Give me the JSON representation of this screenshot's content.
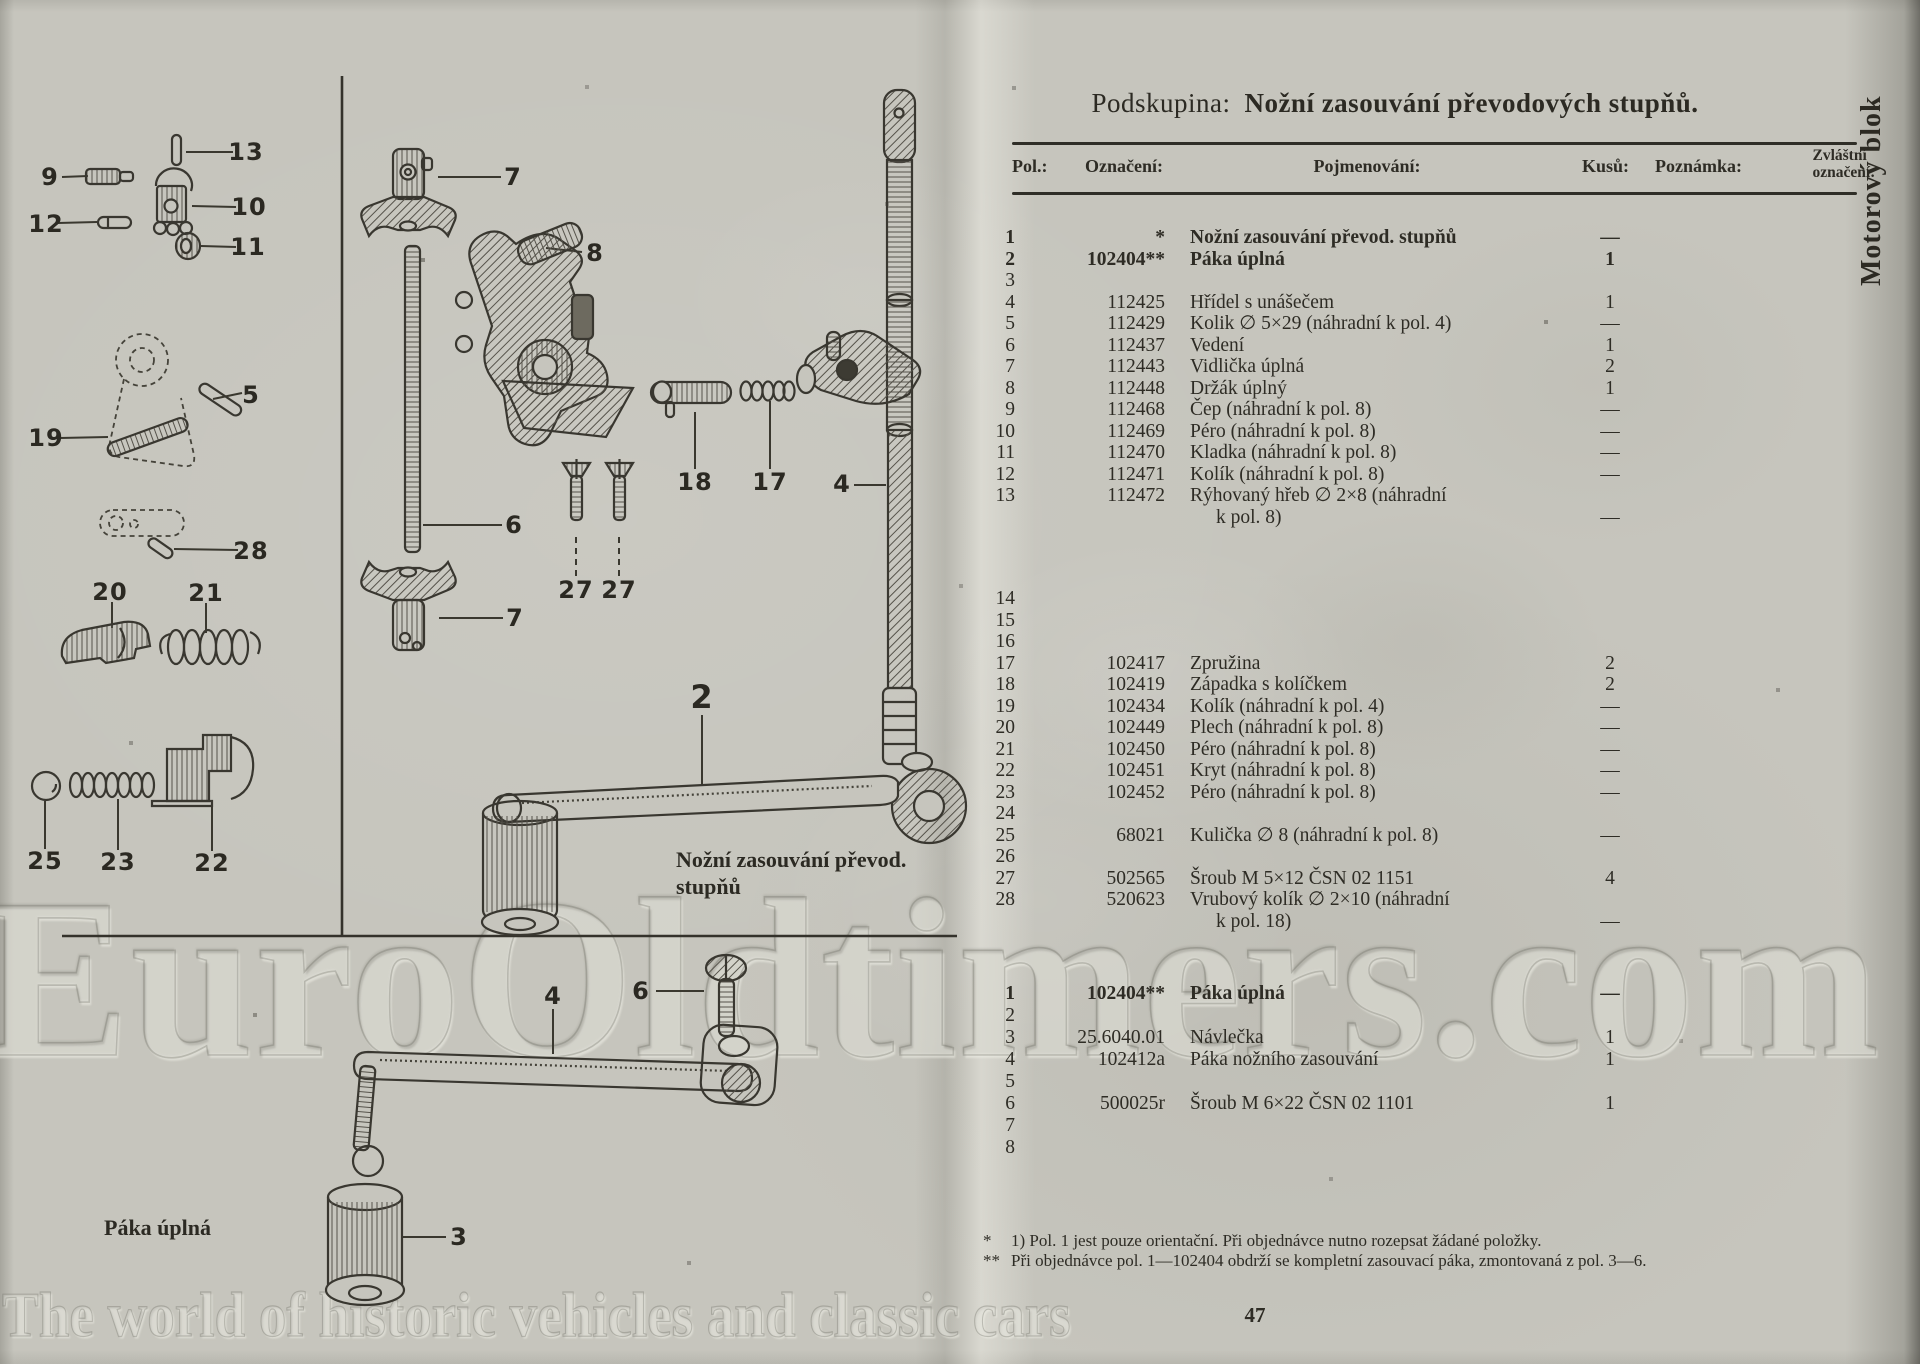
{
  "page": {
    "subgroup_label": "Podskupina:",
    "title": "Nožní zasouvání převodových stupňů.",
    "side_tab": "Motorový blok",
    "page_number": "47",
    "watermark": "EuroOldtimers.com",
    "watermark_tagline": "The world of historic vehicles and classic cars"
  },
  "colors": {
    "ink": "#33312a",
    "paper": "#c6c5bd"
  },
  "table": {
    "headers": {
      "pol": "Pol.:",
      "code": "Označení:",
      "name": "Pojmenování:",
      "qty": "Kusů:",
      "note": "Poznámka:",
      "special_line1": "Zvláštní",
      "special_line2": "označení:"
    },
    "sections": [
      {
        "rows": [
          {
            "pol": "1",
            "code": "*",
            "name": "Nožní zasouvání převod. stupňů",
            "qty": "—",
            "bold": true
          },
          {
            "pol": "2",
            "code": "102404**",
            "name": "Páka úplná",
            "qty": "1",
            "bold": true
          },
          {
            "pol": "3"
          },
          {
            "pol": "4",
            "code": "112425",
            "name": "Hřídel s unášečem",
            "qty": "1"
          },
          {
            "pol": "5",
            "code": "112429",
            "name": "Kolik ∅ 5×29 (náhradní k pol. 4)",
            "qty": "—"
          },
          {
            "pol": "6",
            "code": "112437",
            "name": "Vedení",
            "qty": "1"
          },
          {
            "pol": "7",
            "code": "112443",
            "name": "Vidlička úplná",
            "qty": "2"
          },
          {
            "pol": "8",
            "code": "112448",
            "name": "Držák úplný",
            "qty": "1"
          },
          {
            "pol": "9",
            "code": "112468",
            "name": "Čep (náhradní k pol. 8)",
            "qty": "—"
          },
          {
            "pol": "10",
            "code": "112469",
            "name": "Péro (náhradní k pol. 8)",
            "qty": "—"
          },
          {
            "pol": "11",
            "code": "112470",
            "name": "Kladka (náhradní k pol. 8)",
            "qty": "—"
          },
          {
            "pol": "12",
            "code": "112471",
            "name": "Kolík (náhradní k pol. 8)",
            "qty": "—"
          },
          {
            "pol": "13",
            "code": "112472",
            "name": "Rýhovaný hřeb ∅ 2×8 (náhradní",
            "name2": "k pol. 8)",
            "qty2": "—"
          },
          {
            "pol": "14",
            "gap_before": 60
          },
          {
            "pol": "15"
          },
          {
            "pol": "16"
          },
          {
            "pol": "17",
            "code": "102417",
            "name": "Zpružina",
            "qty": "2"
          },
          {
            "pol": "18",
            "code": "102419",
            "name": "Západka s kolíčkem",
            "qty": "2"
          },
          {
            "pol": "19",
            "code": "102434",
            "name": "Kolík (náhradní k pol. 4)",
            "qty": "—"
          },
          {
            "pol": "20",
            "code": "102449",
            "name": "Plech (náhradní k pol. 8)",
            "qty": "—"
          },
          {
            "pol": "21",
            "code": "102450",
            "name": "Péro (náhradní k pol. 8)",
            "qty": "—"
          },
          {
            "pol": "22",
            "code": "102451",
            "name": "Kryt (náhradní k pol. 8)",
            "qty": "—"
          },
          {
            "pol": "23",
            "code": "102452",
            "name": "Péro (náhradní k pol. 8)",
            "qty": "—"
          },
          {
            "pol": "24"
          },
          {
            "pol": "25",
            "code": "68021",
            "name": "Kulička ∅ 8 (náhradní k pol. 8)",
            "qty": "—"
          },
          {
            "pol": "26"
          },
          {
            "pol": "27",
            "code": "502565",
            "name": "Šroub M 5×12 ČSN 02 1151",
            "qty": "4"
          },
          {
            "pol": "28",
            "code": "520623",
            "name": "Vrubový kolík ∅ 2×10 (náhradní",
            "name2": "k pol. 18)",
            "qty2": "—"
          }
        ]
      },
      {
        "rows": [
          {
            "pol": "1",
            "code": "102404**",
            "name": "Páka úplná",
            "qty": "—",
            "bold": true
          },
          {
            "pol": "2"
          },
          {
            "pol": "3",
            "code": "25.6040.01",
            "name": "Návlečka",
            "qty": "1"
          },
          {
            "pol": "4",
            "code": "102412a",
            "name": "Páka nožního zasouvání",
            "qty": "1"
          },
          {
            "pol": "5"
          },
          {
            "pol": "6",
            "code": "500025r",
            "name": "Šroub M 6×22 ČSN 02 1101",
            "qty": "1"
          },
          {
            "pol": "7"
          },
          {
            "pol": "8"
          }
        ]
      }
    ]
  },
  "footnotes": [
    {
      "marker": "*",
      "text": "1) Pol. 1 jest pouze orientační. Při objednávce nutno rozepsat žádané položky."
    },
    {
      "marker": "**",
      "text": "Při objednávce pol. 1—102404 obdrží se kompletní zasouvací páka, zmontovaná z pol. 3—6."
    }
  ],
  "diagram": {
    "caption_main_line1": "Nožní zasouvání převod.",
    "caption_main_line2": "stupňů",
    "caption_lower": "Páka úplná",
    "callouts": [
      {
        "label": "13",
        "x": 246,
        "y": 152
      },
      {
        "label": "9",
        "x": 50,
        "y": 177
      },
      {
        "label": "10",
        "x": 249,
        "y": 207
      },
      {
        "label": "12",
        "x": 46,
        "y": 224
      },
      {
        "label": "11",
        "x": 248,
        "y": 247
      },
      {
        "label": "5",
        "x": 251,
        "y": 395
      },
      {
        "label": "19",
        "x": 46,
        "y": 438
      },
      {
        "label": "28",
        "x": 251,
        "y": 551
      },
      {
        "label": "20",
        "x": 110,
        "y": 592
      },
      {
        "label": "21",
        "x": 206,
        "y": 593
      },
      {
        "label": "25",
        "x": 45,
        "y": 861
      },
      {
        "label": "23",
        "x": 118,
        "y": 862
      },
      {
        "label": "22",
        "x": 212,
        "y": 863
      },
      {
        "label": "7",
        "x": 513,
        "y": 177
      },
      {
        "label": "8",
        "x": 595,
        "y": 253
      },
      {
        "label": "6",
        "x": 514,
        "y": 525
      },
      {
        "label": "7",
        "x": 515,
        "y": 618
      },
      {
        "label": "27",
        "x": 576,
        "y": 590
      },
      {
        "label": "27",
        "x": 619,
        "y": 590
      },
      {
        "label": "18",
        "x": 695,
        "y": 482
      },
      {
        "label": "17",
        "x": 770,
        "y": 482
      },
      {
        "label": "4",
        "x": 842,
        "y": 484
      },
      {
        "label": "2",
        "x": 702,
        "y": 697,
        "size": 32
      },
      {
        "label": "4",
        "x": 553,
        "y": 996
      },
      {
        "label": "6",
        "x": 641,
        "y": 991
      },
      {
        "label": "3",
        "x": 459,
        "y": 1237
      }
    ]
  }
}
